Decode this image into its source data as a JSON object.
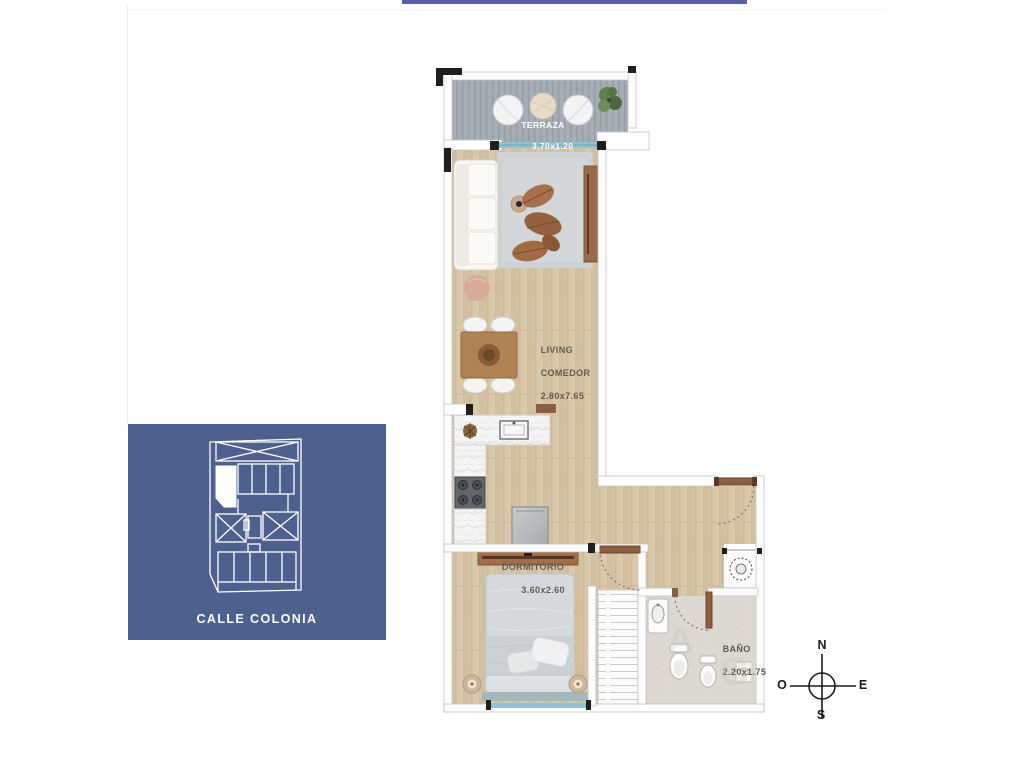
{
  "accents": {
    "top_bar_color": "#5b5fa9"
  },
  "location_inset": {
    "bg_color": "#4e608e",
    "street_label": "CALLE COLONIA"
  },
  "floor_plan": {
    "label_color": "#5f5b52",
    "rooms": {
      "terraza": {
        "name": "TERRAZA",
        "dims": "3.70x1.20"
      },
      "living": {
        "name_line1": "LIVING",
        "name_line2": "COMEDOR",
        "dims": "2.80x7.65"
      },
      "dormitorio": {
        "name": "DORMITORIO",
        "dims": "3.60x2.60"
      },
      "bano": {
        "name": "BAÑO",
        "dims": "2.20x1.75"
      }
    },
    "watermark_letters": {
      "first": "A",
      "second": "C"
    },
    "colors": {
      "wood": "#d9c7a8",
      "deck": "#a6adb5",
      "glass": "#8fc3d3",
      "wall": "#ffffff",
      "rug": "#ced2d4",
      "tile": "#ded9d0"
    }
  },
  "compass": {
    "north": "N",
    "east": "E",
    "south": "S",
    "west": "O"
  }
}
